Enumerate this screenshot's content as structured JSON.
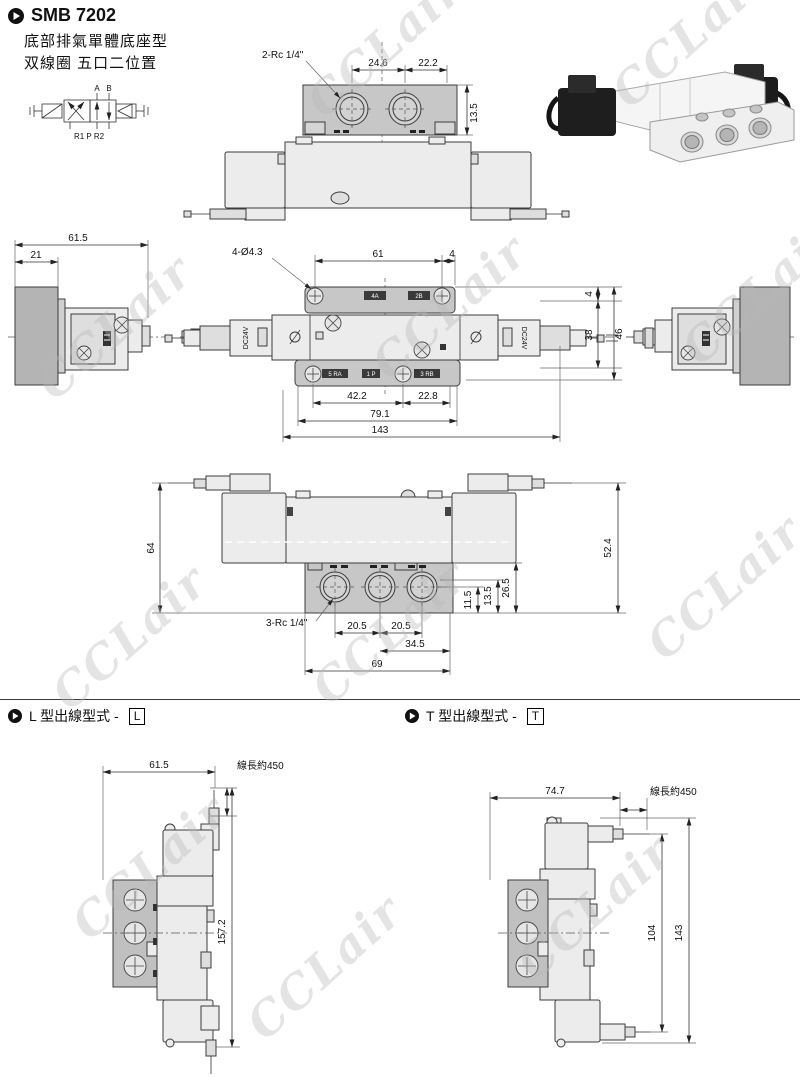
{
  "page": {
    "title": "SMB 7202",
    "subtitle1": "底部排氣單體底座型",
    "subtitle2": "双線圈 五口二位置",
    "watermark": "CCLair"
  },
  "symbol": {
    "port_a": "A",
    "port_b": "B",
    "ports_bottom": "R1 P R2"
  },
  "view_top": {
    "thread_label": "2-Rc 1/4\"",
    "dim_width_left": "24.6",
    "dim_width_right": "22.2",
    "dim_height": "13.5"
  },
  "view_side_left": {
    "dim_total": "61.5",
    "dim_coil": "21"
  },
  "view_plan": {
    "hole_label": "4-Ø4.3",
    "dim_top_center": "61",
    "dim_top_right": "4",
    "dim_bottom_a": "42.2",
    "dim_bottom_b": "22.8",
    "dim_bottom_c": "79.1",
    "dim_bottom_total": "143",
    "dim_right_offset": "4",
    "dim_right_body": "38",
    "dim_right_total": "46",
    "coil_left_label": "DC24V",
    "coil_right_label": "DC24V",
    "port_top_a": "4A",
    "port_top_b": "2B",
    "port_bottom_a": "5 RA",
    "port_bottom_b": "1 P",
    "port_bottom_c": "3 RB"
  },
  "view_front": {
    "thread_label": "3-Rc 1/4\"",
    "dim_height_left": "64",
    "dim_height_right": "52.4",
    "dim_base_inner": "11.5",
    "dim_base_mid": "13.5",
    "dim_base_outer": "26.5",
    "dim_port_a": "20.5",
    "dim_port_b": "20.5",
    "dim_port_c": "34.5",
    "dim_base_width": "69"
  },
  "section_l": {
    "title": "L 型出線型式 -",
    "code": "L",
    "dim_width": "61.5",
    "wire_label": "線長約450",
    "dim_height": "157.2"
  },
  "section_t": {
    "title": "T 型出線型式 -",
    "code": "T",
    "dim_width": "74.7",
    "wire_label": "線長約450",
    "dim_height_inner": "104",
    "dim_height_total": "143"
  }
}
